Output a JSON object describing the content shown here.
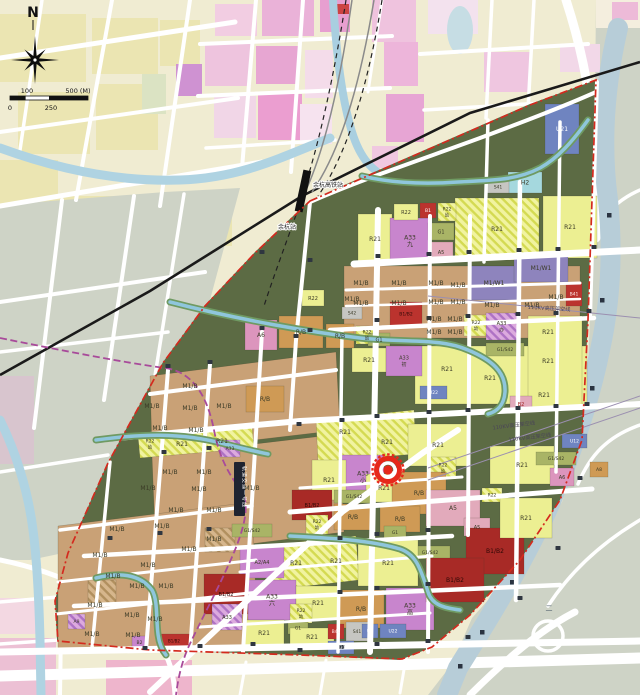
{
  "map": {
    "type": "urban-planning-zoning-map",
    "compass_label": "N",
    "scale_labels": [
      "0",
      "100",
      "250",
      "500 (M)"
    ],
    "station_labels": [
      "余杭高铁站",
      "余杭站"
    ],
    "power_line_label": "110KV高压架空线",
    "metro_label": "轨道交通一号线",
    "canal_char": "二",
    "marker": {
      "x": 388,
      "y": 470
    },
    "colors": {
      "site_green": "#5c6b44",
      "residential_yellow": "#ecef92",
      "industrial_tan": "#c9a176",
      "mixed_orange": "#cf9a55",
      "civic_purple": "#c885cd",
      "industrial_purple": "#8e84bd",
      "commercial_red": "#bb332e",
      "commercial_dark_red": "#a82a26",
      "amenity_pink": "#e2aabb",
      "amenity_pink_dark": "#dc95bd",
      "green_olive": "#a9b466",
      "utility_blue": "#6f84c0",
      "hospital_cyan": "#a5d8de",
      "grey": "#c6c6c2",
      "boundary_red": "#d42a1e",
      "metro_purple": "#a84a9a",
      "water_blue": "#8fc6dc",
      "rail_black": "#1a1a1a",
      "outside_cream": "#f0ecd2",
      "outside_grey": "#ced3c6"
    },
    "parcels": [
      {
        "f": "T",
        "x": 344,
        "y": 266,
        "w": 236,
        "h": 72
      },
      {
        "f": "T",
        "poly": [
          [
            150,
            376
          ],
          [
            336,
            352
          ],
          [
            340,
            430
          ],
          [
            152,
            452
          ]
        ]
      },
      {
        "f": "T",
        "poly": [
          [
            152,
            456
          ],
          [
            340,
            434
          ],
          [
            344,
            532
          ],
          [
            156,
            556
          ]
        ]
      },
      {
        "f": "T",
        "poly": [
          [
            58,
            526
          ],
          [
            252,
            502
          ],
          [
            258,
            648
          ],
          [
            58,
            652
          ]
        ]
      },
      {
        "f": "Y",
        "x": 415,
        "y": 346,
        "w": 172,
        "h": 58
      },
      {
        "f": "Y",
        "x": 528,
        "y": 316,
        "w": 54,
        "h": 92
      },
      {
        "f": "YH",
        "poly": [
          [
            138,
            436
          ],
          [
            252,
            426
          ],
          [
            254,
            448
          ],
          [
            140,
            458
          ]
        ]
      },
      {
        "f": "YH",
        "poly": [
          [
            316,
            420
          ],
          [
            414,
            410
          ],
          [
            416,
            454
          ],
          [
            318,
            462
          ]
        ]
      },
      {
        "f": "YH",
        "poly": [
          [
            270,
            545
          ],
          [
            356,
            536
          ],
          [
            359,
            580
          ],
          [
            273,
            590
          ]
        ]
      },
      {
        "f": "TH",
        "x": 88,
        "y": 580,
        "w": 28,
        "h": 26
      },
      {
        "f": "TH",
        "x": 205,
        "y": 528,
        "w": 30,
        "h": 24
      },
      {
        "l": "R21",
        "f": "YH",
        "x": 455,
        "y": 198,
        "w": 84,
        "h": 62
      },
      {
        "l": "R21",
        "f": "Y",
        "x": 543,
        "y": 196,
        "w": 54,
        "h": 62
      },
      {
        "l": "R21",
        "f": "Y",
        "x": 358,
        "y": 214,
        "w": 34,
        "h": 50
      },
      {
        "l": "A33|九",
        "f": "P",
        "x": 390,
        "y": 218,
        "w": 40,
        "h": 46
      },
      {
        "l": "R22",
        "f": "Y",
        "x": 394,
        "y": 204,
        "w": 24,
        "h": 16,
        "fs": 5
      },
      {
        "l": "B1",
        "f": "R",
        "x": 420,
        "y": 203,
        "w": 16,
        "h": 15,
        "tc": "#ffffff",
        "fs": 4.5
      },
      {
        "l": "R22|幼",
        "f": "YH",
        "x": 438,
        "y": 203,
        "w": 18,
        "h": 18,
        "fs": 4.5
      },
      {
        "l": "G1",
        "f": "G",
        "x": 428,
        "y": 223,
        "w": 26,
        "h": 17,
        "fs": 5
      },
      {
        "l": "A5",
        "f": "K",
        "x": 429,
        "y": 242,
        "w": 24,
        "h": 20,
        "fs": 5
      },
      {
        "l": "H2",
        "f": "C",
        "x": 508,
        "y": 172,
        "w": 34,
        "h": 21
      },
      {
        "l": "S41",
        "f": "GR",
        "x": 487,
        "y": 181,
        "w": 22,
        "h": 12,
        "fs": 4.5
      },
      {
        "l": "U21",
        "f": "U",
        "x": 545,
        "y": 104,
        "w": 34,
        "h": 50,
        "tc": "#ffffff"
      },
      {
        "l": "M1/W1",
        "f": "W",
        "x": 468,
        "y": 266,
        "w": 52,
        "h": 34
      },
      {
        "l": "M1/W1",
        "f": "W",
        "x": 514,
        "y": 254,
        "w": 54,
        "h": 28
      },
      {
        "l": "B41",
        "f": "R",
        "x": 566,
        "y": 282,
        "w": 16,
        "h": 24,
        "tc": "#ffecec",
        "fs": 4.5
      },
      {
        "l": "R22|幼",
        "f": "YH",
        "x": 464,
        "y": 315,
        "w": 24,
        "h": 21,
        "fs": 4.5
      },
      {
        "l": "A33|办",
        "f": "PH",
        "x": 486,
        "y": 313,
        "w": 31,
        "h": 27,
        "fs": 5
      },
      {
        "l": "R22",
        "f": "Y",
        "x": 302,
        "y": 290,
        "w": 22,
        "h": 16,
        "fs": 5
      },
      {
        "l": "A6",
        "f": "K2",
        "x": 245,
        "y": 320,
        "w": 32,
        "h": 30
      },
      {
        "l": "R/B",
        "f": "O",
        "x": 279,
        "y": 316,
        "w": 44,
        "h": 32
      },
      {
        "l": "R/B",
        "f": "O",
        "x": 326,
        "y": 324,
        "w": 28,
        "h": 24
      },
      {
        "l": "R22|幼",
        "f": "YH",
        "x": 356,
        "y": 326,
        "w": 22,
        "h": 18,
        "fs": 4.5
      },
      {
        "l": "G1",
        "f": "G",
        "x": 368,
        "y": 333,
        "w": 22,
        "h": 13,
        "fs": 5
      },
      {
        "l": "B1/B2",
        "f": "R",
        "x": 390,
        "y": 302,
        "w": 32,
        "h": 24,
        "tc": "#2d0705",
        "fs": 4.5
      },
      {
        "l": "R21",
        "f": "Y",
        "x": 352,
        "y": 348,
        "w": 34,
        "h": 24
      },
      {
        "l": "A33|初",
        "f": "P",
        "x": 386,
        "y": 346,
        "w": 36,
        "h": 30,
        "fs": 5
      },
      {
        "l": "R/B",
        "f": "O",
        "x": 246,
        "y": 386,
        "w": 38,
        "h": 26
      },
      {
        "l": "S42",
        "f": "GR",
        "x": 342,
        "y": 307,
        "w": 20,
        "h": 12,
        "fs": 4.5
      },
      {
        "l": "U22",
        "f": "U",
        "x": 420,
        "y": 386,
        "w": 27,
        "h": 13,
        "tc": "#ffffff",
        "fs": 4.5
      },
      {
        "l": "G1/S42",
        "f": "G",
        "x": 486,
        "y": 343,
        "w": 38,
        "h": 13,
        "fs": 4.5
      },
      {
        "l": "R21",
        "f": "Y",
        "x": 408,
        "y": 424,
        "w": 60,
        "h": 42
      },
      {
        "l": "A33|小",
        "f": "P",
        "x": 342,
        "y": 455,
        "w": 42,
        "h": 44
      },
      {
        "l": "R21",
        "f": "Y",
        "x": 366,
        "y": 474,
        "w": 36,
        "h": 28
      },
      {
        "l": "R21",
        "f": "Y",
        "x": 312,
        "y": 460,
        "w": 34,
        "h": 40
      },
      {
        "l": "R22|幼",
        "f": "YH",
        "x": 430,
        "y": 457,
        "w": 26,
        "h": 22,
        "fs": 4.5
      },
      {
        "l": "R/B",
        "f": "O",
        "x": 392,
        "y": 472,
        "w": 54,
        "h": 42
      },
      {
        "l": "A5",
        "f": "K",
        "x": 426,
        "y": 490,
        "w": 54,
        "h": 36
      },
      {
        "l": "B1/B2",
        "f": "RD",
        "x": 292,
        "y": 490,
        "w": 40,
        "h": 30,
        "tc": "#2d0705",
        "fs": 5
      },
      {
        "l": "R/B",
        "f": "O",
        "x": 334,
        "y": 504,
        "w": 38,
        "h": 26
      },
      {
        "l": "R/B",
        "f": "O",
        "x": 380,
        "y": 506,
        "w": 40,
        "h": 26
      },
      {
        "l": "R22|幼",
        "f": "YH",
        "x": 306,
        "y": 515,
        "w": 22,
        "h": 19,
        "fs": 4.5
      },
      {
        "l": "G1/S42",
        "f": "G",
        "x": 334,
        "y": 490,
        "w": 40,
        "h": 13,
        "fs": 4.5
      },
      {
        "l": "G1",
        "f": "G",
        "x": 384,
        "y": 526,
        "w": 22,
        "h": 13,
        "fs": 4.5
      },
      {
        "l": "A5",
        "f": "K",
        "x": 464,
        "y": 518,
        "w": 26,
        "h": 18,
        "fs": 5
      },
      {
        "l": "R22",
        "f": "YH",
        "x": 482,
        "y": 488,
        "w": 20,
        "h": 14,
        "fs": 4.5
      },
      {
        "l": "R21",
        "f": "Y",
        "x": 490,
        "y": 446,
        "w": 64,
        "h": 38
      },
      {
        "l": "G1/S42",
        "f": "G",
        "x": 410,
        "y": 546,
        "w": 40,
        "h": 13,
        "fs": 4.5
      },
      {
        "l": "G1/S42",
        "f": "G",
        "x": 536,
        "y": 452,
        "w": 40,
        "h": 13,
        "fs": 4.5
      },
      {
        "l": "B2",
        "f": "K",
        "x": 510,
        "y": 396,
        "w": 22,
        "h": 16,
        "tc": "#a02020",
        "fs": 5
      },
      {
        "l": "A6",
        "f": "K2",
        "x": 550,
        "y": 468,
        "w": 24,
        "h": 18,
        "fs": 5
      },
      {
        "l": "U12",
        "f": "U",
        "x": 562,
        "y": 434,
        "w": 25,
        "h": 14,
        "tc": "#ffffff",
        "fs": 4.5
      },
      {
        "l": "A8",
        "f": "O",
        "x": 590,
        "y": 462,
        "w": 18,
        "h": 15,
        "fs": 4.5
      },
      {
        "l": "G1/S42",
        "f": "G",
        "x": 232,
        "y": 524,
        "w": 40,
        "h": 13,
        "fs": 4.5
      },
      {
        "l": "A2/A4",
        "f": "P",
        "x": 240,
        "y": 546,
        "w": 44,
        "h": 32,
        "fs": 5
      },
      {
        "l": "R21",
        "f": "Y",
        "x": 358,
        "y": 540,
        "w": 60,
        "h": 46
      },
      {
        "l": "A33|六",
        "f": "P",
        "x": 248,
        "y": 580,
        "w": 48,
        "h": 40
      },
      {
        "l": "R21",
        "f": "Y",
        "x": 296,
        "y": 586,
        "w": 44,
        "h": 34
      },
      {
        "l": "R/B",
        "f": "O",
        "x": 338,
        "y": 590,
        "w": 46,
        "h": 38
      },
      {
        "l": "A33|高",
        "f": "P",
        "x": 386,
        "y": 588,
        "w": 48,
        "h": 42
      },
      {
        "l": "R22|幼",
        "f": "YH",
        "x": 290,
        "y": 604,
        "w": 22,
        "h": 19,
        "fs": 4.5
      },
      {
        "l": "G1",
        "f": "G",
        "x": 288,
        "y": 622,
        "w": 20,
        "h": 12,
        "fs": 4.5
      },
      {
        "l": "R21",
        "f": "Y",
        "x": 244,
        "y": 620,
        "w": 40,
        "h": 26
      },
      {
        "l": "R21",
        "f": "Y",
        "x": 290,
        "y": 628,
        "w": 44,
        "h": 18
      },
      {
        "l": "B41",
        "f": "R",
        "x": 328,
        "y": 624,
        "w": 16,
        "h": 15,
        "tc": "#ffecec",
        "fs": 4.5
      },
      {
        "l": "S41",
        "f": "GR",
        "x": 346,
        "y": 622,
        "w": 22,
        "h": 19,
        "fs": 4.5
      },
      {
        "l": "U9",
        "f": "U",
        "x": 362,
        "y": 624,
        "w": 16,
        "h": 14,
        "tc": "#ffffff",
        "fs": 4.5
      },
      {
        "l": "U22",
        "f": "U",
        "x": 380,
        "y": 624,
        "w": 26,
        "h": 14,
        "tc": "#ffffff",
        "fs": 4.5
      },
      {
        "l": "U31",
        "f": "U",
        "x": 328,
        "y": 641,
        "w": 26,
        "h": 13,
        "tc": "#ffffff",
        "fs": 4.5
      },
      {
        "l": "B1/B2",
        "f": "RD",
        "x": 466,
        "y": 528,
        "w": 58,
        "h": 46,
        "tc": "#2d0705"
      },
      {
        "l": "B1/B2",
        "f": "RD",
        "x": 426,
        "y": 558,
        "w": 58,
        "h": 44,
        "tc": "#2d0705"
      },
      {
        "l": "R21",
        "f": "Y",
        "x": 500,
        "y": 498,
        "w": 52,
        "h": 40
      },
      {
        "l": "B1/B2",
        "f": "RD",
        "x": 204,
        "y": 574,
        "w": 44,
        "h": 40,
        "tc": "#2d0705",
        "fs": 5
      },
      {
        "l": "A33",
        "f": "PH",
        "x": 212,
        "y": 604,
        "w": 30,
        "h": 26,
        "fs": 5
      },
      {
        "l": "B1/B2",
        "f": "R",
        "x": 158,
        "y": 634,
        "w": 32,
        "h": 14,
        "tc": "#2d0705",
        "fs": 4
      },
      {
        "l": "B2",
        "f": "P",
        "x": 132,
        "y": 636,
        "w": 15,
        "h": 13,
        "fs": 4.5
      },
      {
        "l": "A33",
        "f": "PH",
        "x": 220,
        "y": 440,
        "w": 20,
        "h": 17,
        "fs": 4.5
      },
      {
        "l": "A9",
        "f": "PH",
        "x": 68,
        "y": 614,
        "w": 17,
        "h": 15,
        "fs": 4.5
      }
    ],
    "labels": [
      {
        "t": "M1/B",
        "x": 361,
        "y": 283
      },
      {
        "t": "M1/B",
        "x": 399,
        "y": 283
      },
      {
        "t": "M1/B",
        "x": 361,
        "y": 303
      },
      {
        "t": "M1/B",
        "x": 399,
        "y": 303
      },
      {
        "t": "M1/B",
        "x": 436,
        "y": 283
      },
      {
        "t": "M1/B",
        "x": 458,
        "y": 285
      },
      {
        "t": "M1/B",
        "x": 436,
        "y": 302
      },
      {
        "t": "M1/B",
        "x": 458,
        "y": 302
      },
      {
        "t": "M1/B",
        "x": 434,
        "y": 319
      },
      {
        "t": "M1/B",
        "x": 455,
        "y": 319
      },
      {
        "t": "M1/B",
        "x": 434,
        "y": 332
      },
      {
        "t": "M1/B",
        "x": 455,
        "y": 332
      },
      {
        "t": "M1/B",
        "x": 492,
        "y": 305
      },
      {
        "t": "M1/B",
        "x": 532,
        "y": 305
      },
      {
        "t": "M1/B",
        "x": 556,
        "y": 297
      },
      {
        "t": "M1/B",
        "x": 352,
        "y": 299
      },
      {
        "t": "M1/B",
        "x": 190,
        "y": 386
      },
      {
        "t": "M1/B",
        "x": 152,
        "y": 406
      },
      {
        "t": "M1/B",
        "x": 190,
        "y": 408
      },
      {
        "t": "M1/B",
        "x": 224,
        "y": 406
      },
      {
        "t": "M1/B",
        "x": 160,
        "y": 428
      },
      {
        "t": "M1/B",
        "x": 196,
        "y": 430
      },
      {
        "t": "M1/B",
        "x": 170,
        "y": 472
      },
      {
        "t": "M1/B",
        "x": 204,
        "y": 472
      },
      {
        "t": "M1/B",
        "x": 148,
        "y": 488
      },
      {
        "t": "M1/B",
        "x": 199,
        "y": 489
      },
      {
        "t": "M1/B",
        "x": 252,
        "y": 488
      },
      {
        "t": "M1/B",
        "x": 176,
        "y": 510
      },
      {
        "t": "M1/B",
        "x": 214,
        "y": 510
      },
      {
        "t": "M1/B",
        "x": 117,
        "y": 529
      },
      {
        "t": "M1/B",
        "x": 162,
        "y": 526
      },
      {
        "t": "M1/B",
        "x": 214,
        "y": 539
      },
      {
        "t": "M1/B",
        "x": 100,
        "y": 555
      },
      {
        "t": "M1/B",
        "x": 189,
        "y": 549
      },
      {
        "t": "M1/B",
        "x": 148,
        "y": 565
      },
      {
        "t": "M1/B",
        "x": 113,
        "y": 576
      },
      {
        "t": "M1/B",
        "x": 137,
        "y": 586
      },
      {
        "t": "M1/B",
        "x": 166,
        "y": 586
      },
      {
        "t": "M1/B",
        "x": 95,
        "y": 605
      },
      {
        "t": "M1/B",
        "x": 132,
        "y": 615
      },
      {
        "t": "M1/B",
        "x": 155,
        "y": 619
      },
      {
        "t": "M1/B",
        "x": 92,
        "y": 634
      },
      {
        "t": "M1/B",
        "x": 133,
        "y": 635
      },
      {
        "t": "R21",
        "x": 447,
        "y": 369
      },
      {
        "t": "R21",
        "x": 490,
        "y": 378
      },
      {
        "t": "R21",
        "x": 548,
        "y": 332
      },
      {
        "t": "R21",
        "x": 548,
        "y": 361
      },
      {
        "t": "R21",
        "x": 544,
        "y": 395
      },
      {
        "t": "R21",
        "x": 345,
        "y": 432
      },
      {
        "t": "R21",
        "x": 387,
        "y": 442
      },
      {
        "t": "R21",
        "x": 296,
        "y": 563
      },
      {
        "t": "R21",
        "x": 336,
        "y": 561
      },
      {
        "t": "R22|幼",
        "x": 150,
        "y": 444,
        "fs": 4.5
      },
      {
        "t": "R21",
        "x": 182,
        "y": 444
      },
      {
        "t": "R21",
        "x": 222,
        "y": 441
      },
      {
        "t": "二",
        "x": 549,
        "y": 608,
        "fs": 7,
        "tc": "#5b6b74"
      }
    ],
    "texts": [
      {
        "t": "余杭高铁站",
        "x": 313,
        "y": 187,
        "fs": 6,
        "anchor": "start",
        "tc": "#1c1c1c",
        "halo": true
      },
      {
        "t": "余杭站",
        "x": 296,
        "y": 229,
        "fs": 6,
        "anchor": "end",
        "tc": "#1c1c1c",
        "halo": true
      },
      {
        "t": "110KV高压架空线",
        "x": 549,
        "y": 310,
        "fs": 5.2,
        "rot": 3,
        "tc": "#4a4458"
      },
      {
        "t": "110KV高压架空线",
        "x": 514,
        "y": 427,
        "fs": 5.2,
        "rot": -7,
        "tc": "#4a4458"
      },
      {
        "t": "110KV高压架空线",
        "x": 530,
        "y": 439,
        "fs": 5.2,
        "rot": -7,
        "tc": "#4a4458"
      }
    ]
  }
}
